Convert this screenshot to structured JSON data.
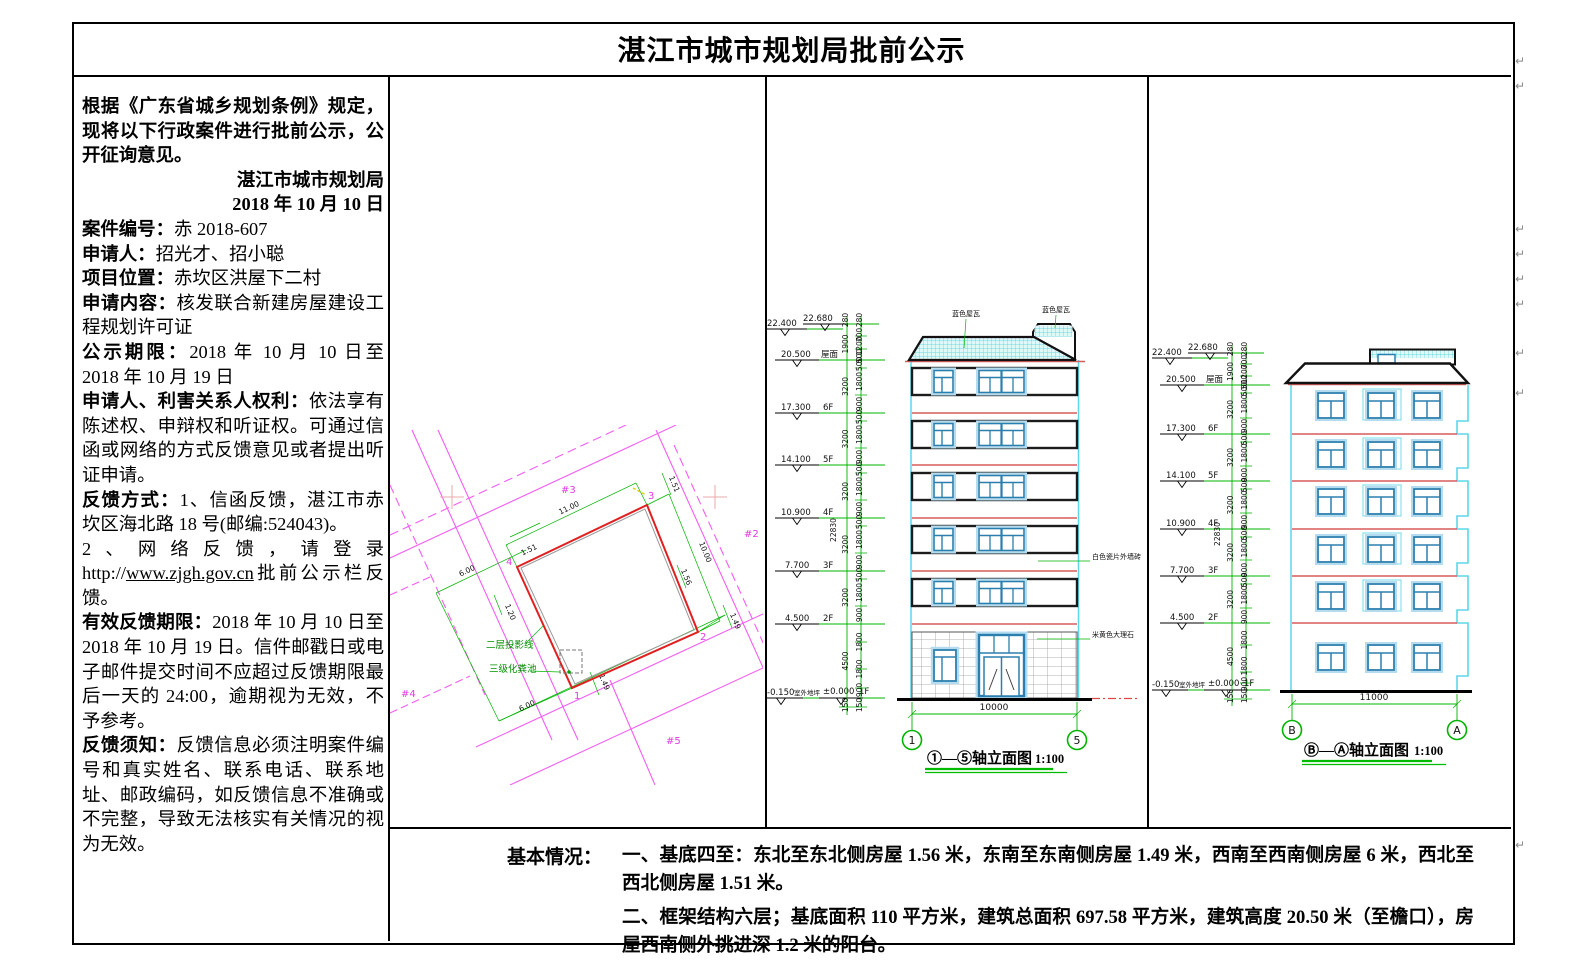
{
  "title": "湛江市城市规划局批前公示",
  "left": {
    "p1": "根据《广东省城乡规划条例》规定，现将以下行政案件进行批前公示，公开征询意见。",
    "org": "湛江市城市规划局",
    "org_date": "2018 年 10 月 10 日",
    "f_case_label": "案件编号：",
    "f_case": "赤 2018-607",
    "f_applicant_label": "申请人：",
    "f_applicant": "招光才、招小聪",
    "f_location_label": "项目位置：",
    "f_location": "赤坎区洪屋下二村",
    "f_content_label": "申请内容：",
    "f_content": "核发联合新建房屋建设工程规划许可证",
    "f_period_label": "公示期限：",
    "f_period": "2018 年 10 月 10 日至 2018 年 10 月 19 日",
    "f_rights_label": "申请人、利害关系人权利：",
    "f_rights": "依法享有陈述权、申辩权和听证权。可通过信函或网络的方式反馈意见或者提出听证申请。",
    "f_method_label": "反馈方式：",
    "f_method": "1、信函反馈，湛江市赤坎区海北路 18 号(邮编:524043)。",
    "web_pre": "2、网络反馈，请登录 http://",
    "web_link": "www.zjgh.gov.cn",
    "web_post": "批前公示栏反馈。",
    "f_valid_label": "有效反馈期限：",
    "f_valid": "2018 年 10 月 10 日至 2018 年 10 月 19 日。信件邮戳日或电子邮件提交时间不应超过反馈期限最后一天的 24:00，逾期视为无效，不予参考。",
    "f_note_label": "反馈须知：",
    "f_note": "反馈信息必须注明案件编号和真实姓名、联系电话、联系地址、邮政编码，如反馈信息不准确或不完整，导致无法核实有关情况的视为无效。"
  },
  "siteplan": {
    "d1100": "11.00",
    "d1000": "10.00",
    "d600": "6.00",
    "d151": "1.51",
    "d156": "1.56",
    "d149": "1.49",
    "d120": "1.20",
    "proj": "二层投影线",
    "septic": "三级化粪池",
    "lot2": "#2",
    "lot3": "#3",
    "lot4": "#4",
    "lot5": "#5",
    "c1": "1",
    "c2": "2",
    "c3": "3",
    "c4": "4"
  },
  "dims": {
    "d150": "150",
    "d280": "280",
    "d500": "500",
    "d700": "700",
    "d900": "900",
    "d1200": "1200",
    "d1800": "1800",
    "d1900": "1900",
    "d3200": "3200",
    "d4500": "4500",
    "d10000": "10000",
    "d11000": "11000",
    "d22830": "22830"
  },
  "levels": {
    "v22400": "22.400",
    "v22680": "22.680",
    "v20500": "20.500",
    "roof": "屋面",
    "v17300": "17.300",
    "f6": "6F",
    "v14100": "14.100",
    "f5": "5F",
    "v10900": "10.900",
    "f4": "4F",
    "v7700": "7.700",
    "f3": "3F",
    "v4500": "4.500",
    "f2": "2F",
    "v0": "±0.000",
    "f1": "1F",
    "vm150": "-0.150",
    "ground": "室外地坪"
  },
  "elev1": {
    "title": "①—⑤轴立面图",
    "scale": "1:100",
    "axis_l": "1",
    "axis_r": "5",
    "note_roof": "蓝色屋瓦",
    "note_wall": "白色瓷片外墙砖",
    "note_stone": "米黄色大理石"
  },
  "elev2": {
    "title": "Ⓑ—Ⓐ轴立面图",
    "scale": "1:100",
    "axis_l": "B",
    "axis_r": "A"
  },
  "basic": {
    "label": "基本情况：",
    "item1": "一、基底四至：东北至东北侧房屋 1.56 米，东南至东南侧房屋 1.49 米，西南至西南侧房屋 6 米，西北至西北侧房屋 1.51 米。",
    "item2": "二、框架结构六层；基底面积 110 平方米，建筑总面积 697.58 平方米，建筑高度 20.50 米（至檐口），房屋西南侧外挑进深 1.2 米的阳台。"
  },
  "marks": {
    "glyph": "↵"
  }
}
